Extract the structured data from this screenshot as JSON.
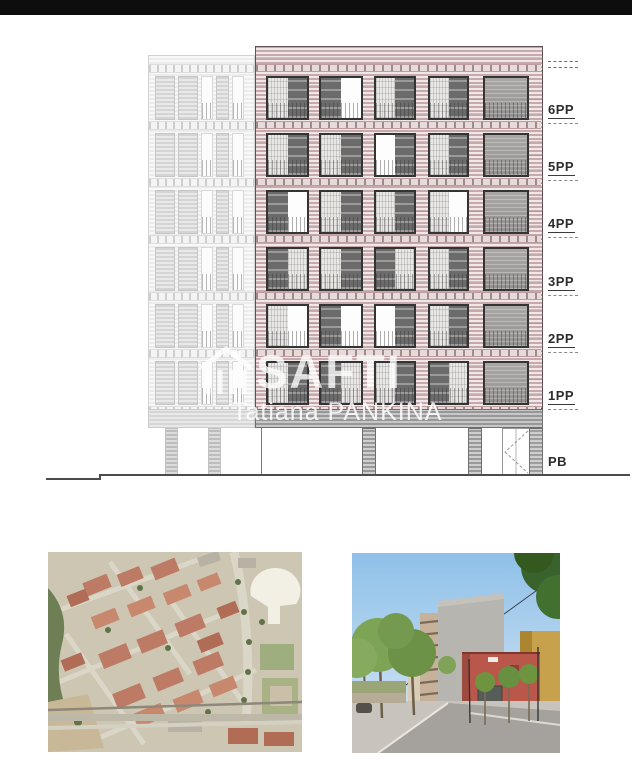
{
  "watermark": {
    "brand": "SAFTI",
    "agent": "Tatiana PANKINA"
  },
  "elevation": {
    "floor_labels": [
      "6PP",
      "5PP",
      "4PP",
      "3PP",
      "2PP",
      "1PP",
      "PB"
    ],
    "floors": [
      {
        "label": "6PP",
        "windows": [
          "LD",
          "DW",
          "LD",
          "LD",
          "T"
        ]
      },
      {
        "label": "5PP",
        "windows": [
          "LD",
          "LD",
          "WD",
          "LD",
          "T"
        ]
      },
      {
        "label": "4PP",
        "windows": [
          "DW",
          "LD",
          "LD",
          "LW",
          "T"
        ]
      },
      {
        "label": "3PP",
        "windows": [
          "DL",
          "LD",
          "DL",
          "LD",
          "T"
        ]
      },
      {
        "label": "2PP",
        "windows": [
          "LW",
          "DW",
          "WD",
          "LD",
          "T"
        ]
      },
      {
        "label": "1PP",
        "windows": [
          "LD",
          "DL",
          "LD",
          "DL",
          "T"
        ]
      }
    ],
    "colors": {
      "facade_stripe": "#c7a9ad",
      "facade_light": "#f0e7e7",
      "slab_band": "#e7dadb",
      "window_frame": "#343434",
      "panel_dark": "#6b6b6b",
      "panel_light": "#e9e7e4",
      "neighbor_gray": "#ececec",
      "canopy_gray": "#979797",
      "top_bar": "#0d0d0d"
    }
  },
  "photos": {
    "aerial": {
      "name": "aerial-site-map-photo"
    },
    "street": {
      "name": "street-view-photo"
    }
  }
}
